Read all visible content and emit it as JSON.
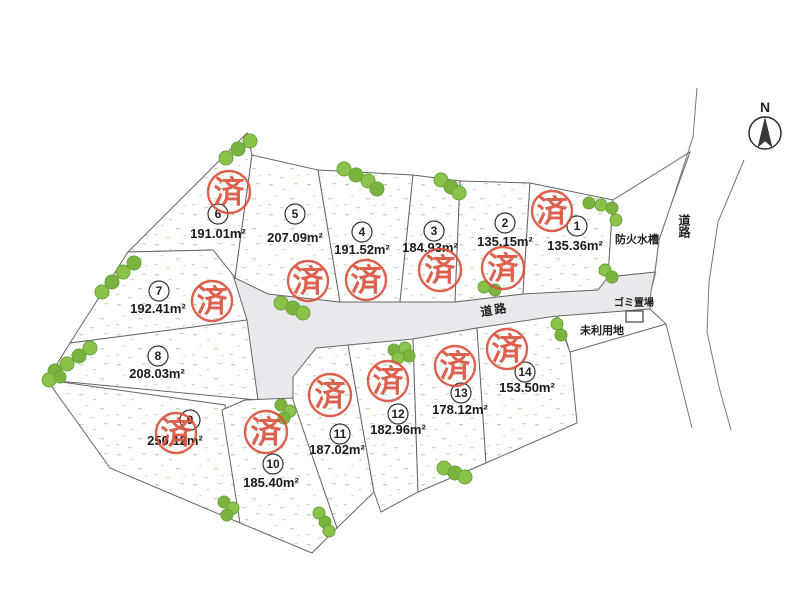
{
  "compass": {
    "north_label": "N"
  },
  "labels": {
    "road": "道路",
    "fire_water_tank": "防火水槽",
    "garbage_place": "ゴミ置場",
    "unused_land": "未利用地"
  },
  "stamp": {
    "label": "済",
    "meaning": "sold",
    "color": "#d9503c"
  },
  "colors": {
    "stamp_red": "#d9503c",
    "tree_green": "#8bc34a",
    "road_gray": "#e9e9ed"
  },
  "lots": [
    {
      "no": "1",
      "area": "135.36m²",
      "sold": true
    },
    {
      "no": "2",
      "area": "135.15m²",
      "sold": true
    },
    {
      "no": "3",
      "area": "184.93m²",
      "sold": true
    },
    {
      "no": "4",
      "area": "191.52m²",
      "sold": true
    },
    {
      "no": "5",
      "area": "207.09m²",
      "sold": true
    },
    {
      "no": "6",
      "area": "191.01m²",
      "sold": true
    },
    {
      "no": "7",
      "area": "192.41m²",
      "sold": true
    },
    {
      "no": "8",
      "area": "208.03m²",
      "sold": false
    },
    {
      "no": "9",
      "area": "250.12m²",
      "sold": true
    },
    {
      "no": "10",
      "area": "185.40m²",
      "sold": true
    },
    {
      "no": "11",
      "area": "187.02m²",
      "sold": true
    },
    {
      "no": "12",
      "area": "182.96m²",
      "sold": true
    },
    {
      "no": "13",
      "area": "178.12m²",
      "sold": true
    },
    {
      "no": "14",
      "area": "153.50m²",
      "sold": true
    }
  ]
}
